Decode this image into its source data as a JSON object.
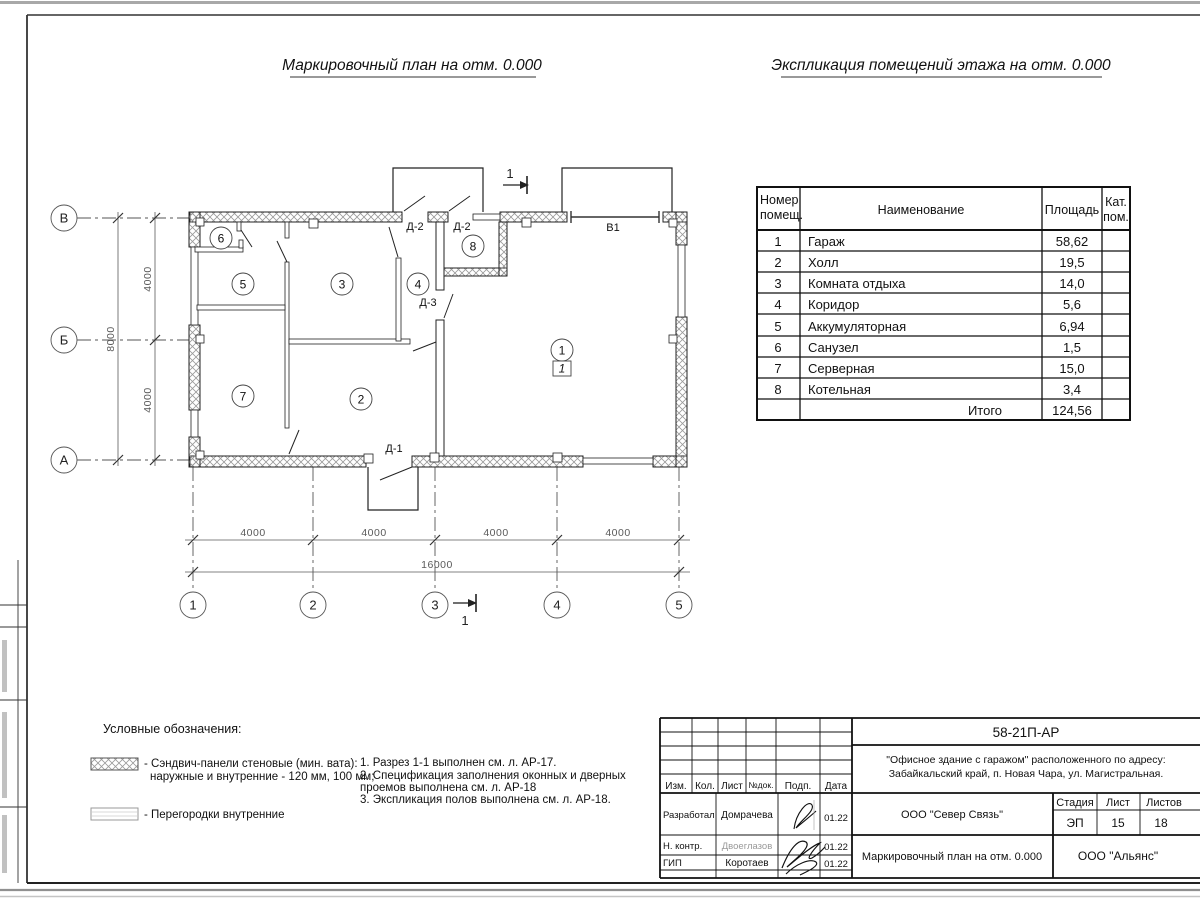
{
  "titles": {
    "plan": "Маркировочный план на отм. 0.000",
    "explication": "Экспликация помещений этажа на отм. 0.000"
  },
  "plan": {
    "axes": {
      "rows": [
        "В",
        "Б",
        "А"
      ],
      "cols": [
        "1",
        "2",
        "3",
        "4",
        "5"
      ]
    },
    "dims": {
      "left": [
        "4000",
        "4000"
      ],
      "left_total": "8000",
      "bottom": [
        "4000",
        "4000",
        "4000",
        "4000"
      ],
      "bottom_total": "16000"
    },
    "rooms": [
      "6",
      "5",
      "3",
      "4",
      "8",
      "7",
      "2",
      "1"
    ],
    "floor_mark": "1",
    "doors": [
      "Д-2",
      "Д-2",
      "В1",
      "Д-3",
      "Д-1"
    ],
    "section_mark": "1"
  },
  "explication": {
    "headers": {
      "col1a": "Номер",
      "col1b": "помещ.",
      "col2": "Наименование",
      "col3": "Площадь",
      "col4a": "Кат.",
      "col4b": "пом."
    },
    "rows": [
      {
        "n": "1",
        "name": "Гараж",
        "area": "58,62"
      },
      {
        "n": "2",
        "name": "Холл",
        "area": "19,5"
      },
      {
        "n": "3",
        "name": "Комната отдыха",
        "area": "14,0"
      },
      {
        "n": "4",
        "name": "Коридор",
        "area": "5,6"
      },
      {
        "n": "5",
        "name": "Аккумуляторная",
        "area": "6,94"
      },
      {
        "n": "6",
        "name": "Санузел",
        "area": "1,5"
      },
      {
        "n": "7",
        "name": "Серверная",
        "area": "15,0"
      },
      {
        "n": "8",
        "name": "Котельная",
        "area": "3,4"
      }
    ],
    "total_label": "Итого",
    "total_area": "124,56"
  },
  "legend": {
    "heading": "Условные обозначения:",
    "sandwich_1": "- Сэндвич-панели стеновые (мин. вата):",
    "sandwich_2": "наружные и внутренние - 120 мм, 100 мм;",
    "partitions": "- Перегородки внутренние"
  },
  "notes": [
    "1. Разрез 1-1 выполнен см. л. АР-17.",
    "2. Спецификация заполнения оконных и дверных",
    "проемов выполнена см. л. АР-18",
    "3. Экспликация полов выполнена см. л. АР-18."
  ],
  "title_block": {
    "doc_number": "58-21П-АР",
    "address_line1": "\"Офисное здание с гаражом\" расположенного по адресу:",
    "address_line2": "Забайкальский край, п. Новая Чара, ул. Магистральная.",
    "cols": {
      "izm": "Изм.",
      "kol": "Кол.",
      "list": "Лист",
      "ndok": "№док.",
      "podp": "Подп.",
      "data": "Дата"
    },
    "roles": {
      "razrabotal": "Разработал",
      "n_kontr": "Н. контр.",
      "gip": "ГИП"
    },
    "names": {
      "razrabotal": "Домрачева",
      "n_kontr": "Двоеглазов",
      "gip": "Коротаев"
    },
    "dates": {
      "razrabotal": "01.22",
      "n_kontr": "01.22",
      "gip": "01.22"
    },
    "org_mid": "ООО \"Север Связь\"",
    "sheet_title": "Маркировочный план на отм. 0.000",
    "stadia_label": "Стадия",
    "list_label": "Лист",
    "listov_label": "Листов",
    "stadia": "ЭП",
    "list": "15",
    "listov": "18",
    "org_right": "ООО \"Альянс\""
  }
}
